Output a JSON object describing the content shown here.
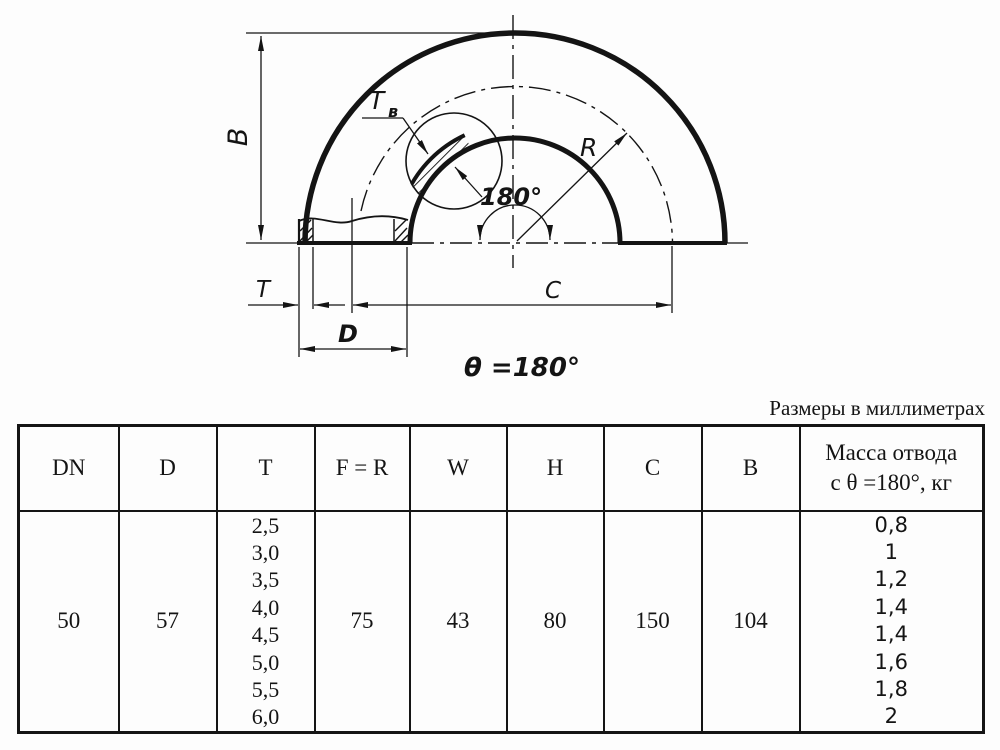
{
  "caption": "Размеры в миллиметрах",
  "drawing": {
    "dim_B": "B",
    "dim_Tv": "T",
    "dim_Tv_sub": "в",
    "dim_R": "R",
    "angle_label": "180°",
    "dim_T": "T",
    "dim_C": "C",
    "dim_D": "D",
    "theta_label": "θ =180°"
  },
  "table": {
    "headers": [
      "DN",
      "D",
      "T",
      "F = R",
      "W",
      "H",
      "C",
      "B"
    ],
    "mass_header_line1": "Масса отвода",
    "mass_header_line2": "с θ =180°, кг",
    "row": {
      "dn": "50",
      "d": "57",
      "t_values": [
        "2,5",
        "3,0",
        "3,5",
        "4,0",
        "4,5",
        "5,0",
        "5,5",
        "6,0"
      ],
      "f_r": "75",
      "w": "43",
      "h": "80",
      "c": "150",
      "b": "104",
      "mass_values": [
        "0,8",
        "1",
        "1,2",
        "1,4",
        "1,4",
        "1,6",
        "1,8",
        "2"
      ]
    }
  }
}
